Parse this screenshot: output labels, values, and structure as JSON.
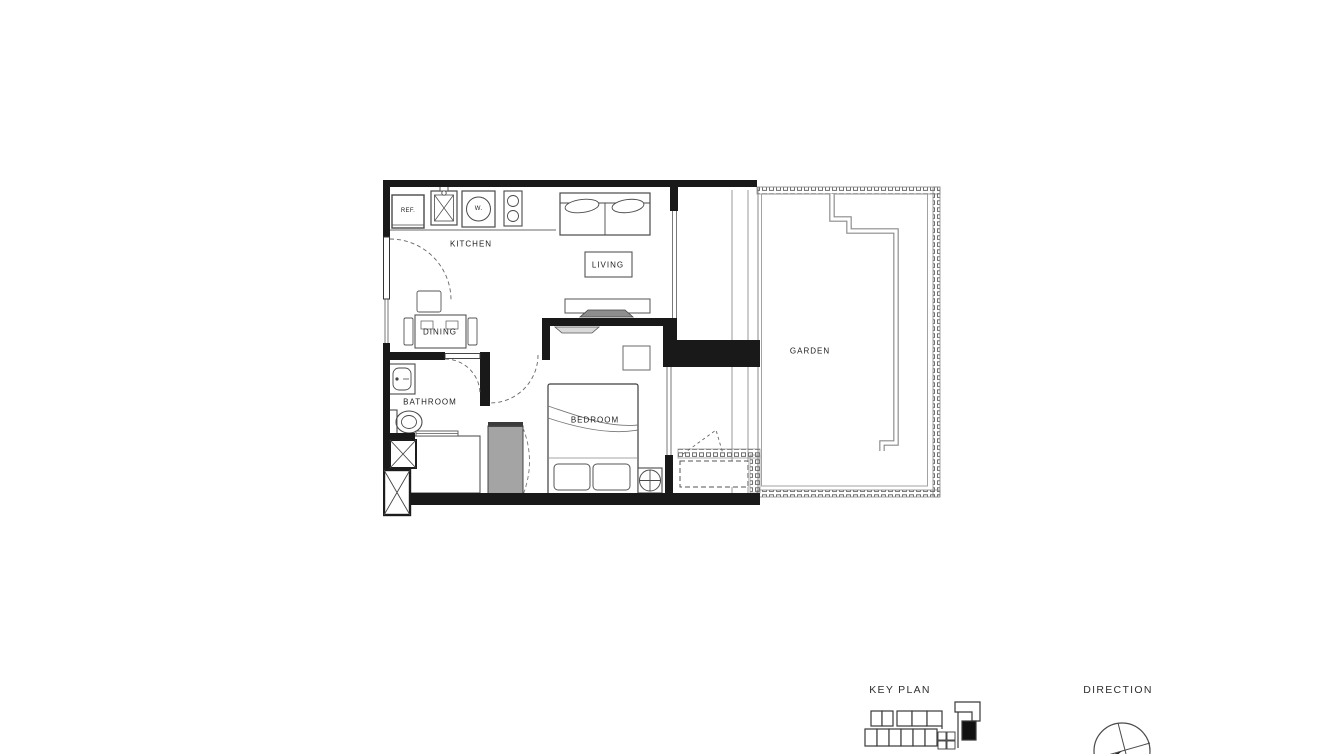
{
  "floor_plan": {
    "rooms": {
      "kitchen": "KITCHEN",
      "living": "LIVING",
      "dining": "DINING",
      "bathroom": "BATHROOM",
      "bedroom": "BEDROOM",
      "garden": "GARDEN"
    },
    "appliances": {
      "refrigerator": "REF.",
      "washer": "W."
    }
  },
  "legend": {
    "key_plan": "KEY PLAN",
    "direction": "DIRECTION"
  },
  "colors": {
    "background": "#ffffff",
    "wall": "#191919",
    "line_dark": "#3a3a3a",
    "line_light": "#8a8a8a"
  }
}
